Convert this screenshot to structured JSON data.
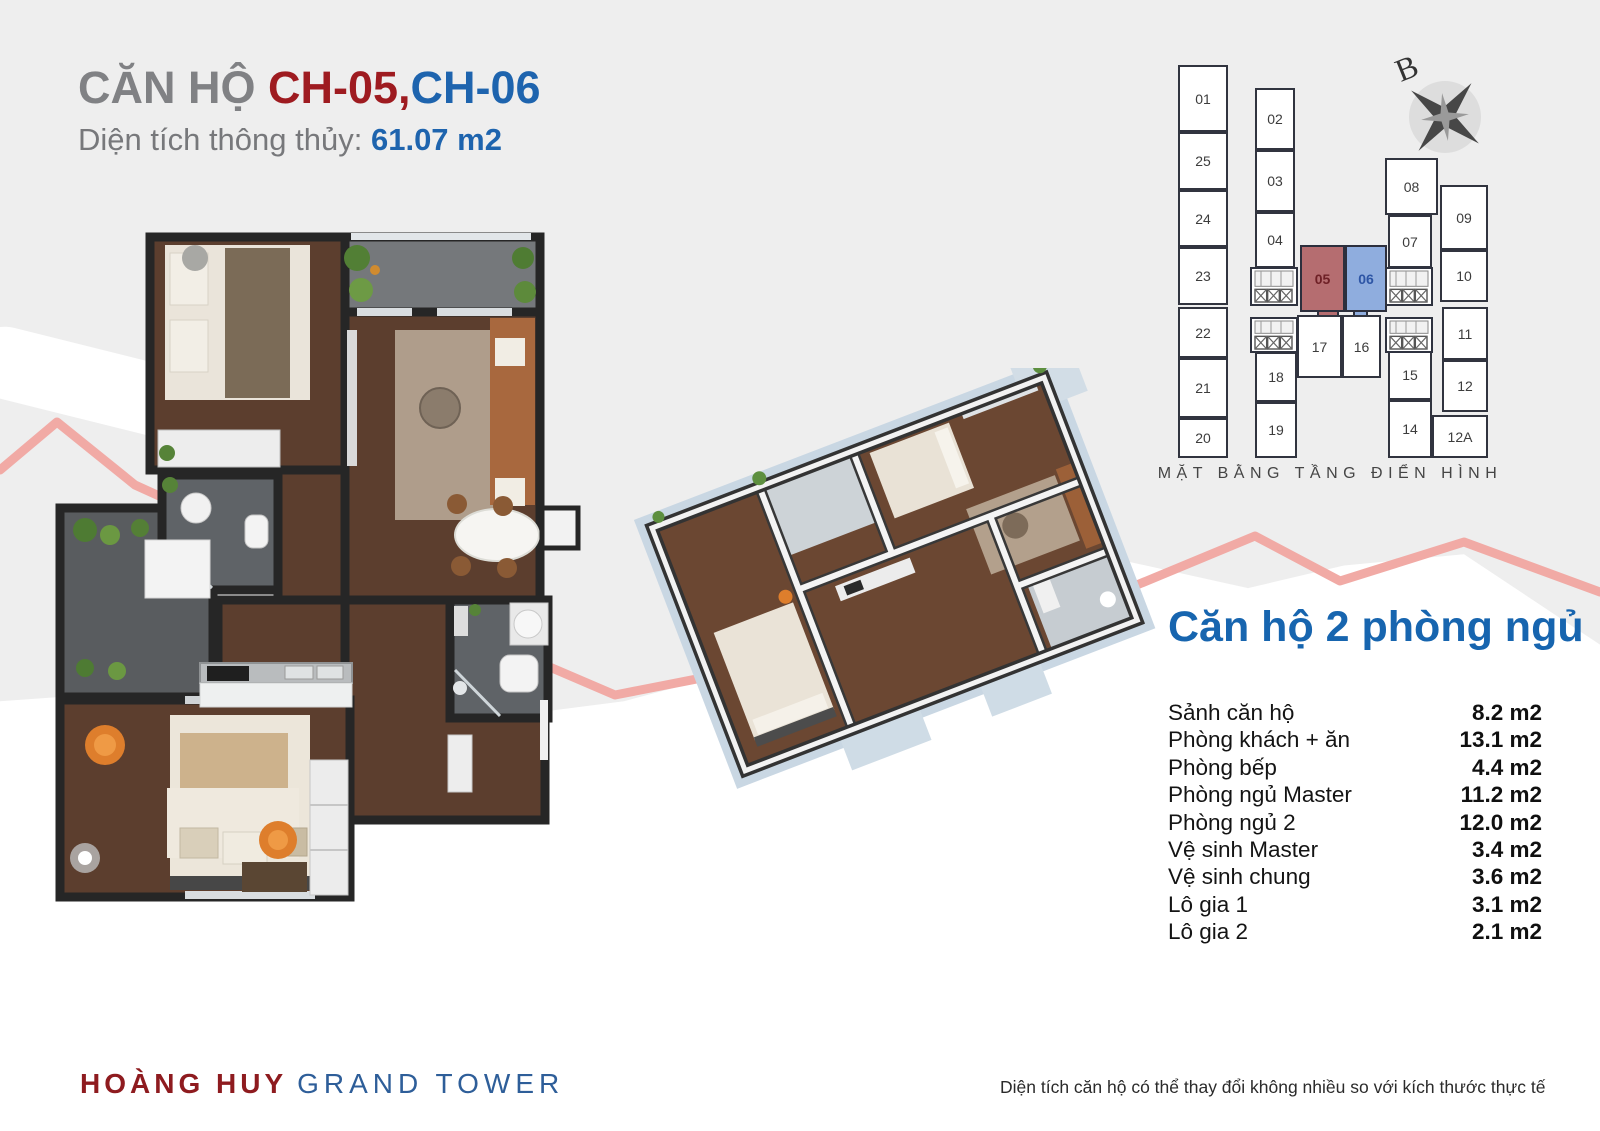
{
  "page": {
    "title_prefix": "CĂN HỘ ",
    "title_unit1": "CH-05,",
    "title_unit2": "CH-06",
    "subtitle_label": "Diện tích thông thủy: ",
    "subtitle_value": "61.07 m2"
  },
  "floor_plate": {
    "caption": "MẶT BẰNG TẦNG ĐIỂN HÌNH",
    "compass_label": "B",
    "highlight_red_unit": "05",
    "highlight_blue_unit": "06",
    "units": [
      {
        "label": "01",
        "highlight": "none"
      },
      {
        "label": "25",
        "highlight": "none"
      },
      {
        "label": "24",
        "highlight": "none"
      },
      {
        "label": "23",
        "highlight": "none"
      },
      {
        "label": "22",
        "highlight": "none"
      },
      {
        "label": "21",
        "highlight": "none"
      },
      {
        "label": "20",
        "highlight": "none"
      },
      {
        "label": "02",
        "highlight": "none"
      },
      {
        "label": "03",
        "highlight": "none"
      },
      {
        "label": "04",
        "highlight": "none"
      },
      {
        "label": "18",
        "highlight": "none"
      },
      {
        "label": "19",
        "highlight": "none"
      },
      {
        "label": "05",
        "highlight": "red"
      },
      {
        "label": "06",
        "highlight": "blue"
      },
      {
        "label": "17",
        "highlight": "none"
      },
      {
        "label": "16",
        "highlight": "none"
      },
      {
        "label": "08",
        "highlight": "none"
      },
      {
        "label": "07",
        "highlight": "none"
      },
      {
        "label": "15",
        "highlight": "none"
      },
      {
        "label": "14",
        "highlight": "none"
      },
      {
        "label": "09",
        "highlight": "none"
      },
      {
        "label": "10",
        "highlight": "none"
      },
      {
        "label": "11",
        "highlight": "none"
      },
      {
        "label": "12",
        "highlight": "none"
      },
      {
        "label": "12A",
        "highlight": "none"
      }
    ],
    "colors": {
      "highlight_red": "#b56d70",
      "highlight_blue": "#8fadde"
    }
  },
  "summary": {
    "heading": "Căn hộ 2 phòng ngủ",
    "rooms": [
      {
        "label": "Sảnh căn hộ",
        "area": "8.2 m2"
      },
      {
        "label": "Phòng khách + ăn",
        "area": "13.1 m2"
      },
      {
        "label": "Phòng bếp",
        "area": "4.4 m2"
      },
      {
        "label": "Phòng ngủ Master",
        "area": "11.2 m2"
      },
      {
        "label": "Phòng ngủ 2",
        "area": "12.0 m2"
      },
      {
        "label": "Vệ sinh Master",
        "area": "3.4 m2"
      },
      {
        "label": "Vệ sinh chung",
        "area": "3.6 m2"
      },
      {
        "label": "Lô gia 1",
        "area": "3.1 m2"
      },
      {
        "label": "Lô gia 2",
        "area": "2.1 m2"
      }
    ]
  },
  "footer": {
    "brand_primary": "HOÀNG HUY",
    "brand_secondary": "GRAND TOWER",
    "disclaimer": "Diện tích căn hộ có thể thay đổi không nhiều so với kích thước thực tế"
  },
  "theme": {
    "accent_red": "#9e1b20",
    "accent_blue": "#1e64ae",
    "wave_pink": "#f1aaa5",
    "wall_dark": "#262626"
  }
}
